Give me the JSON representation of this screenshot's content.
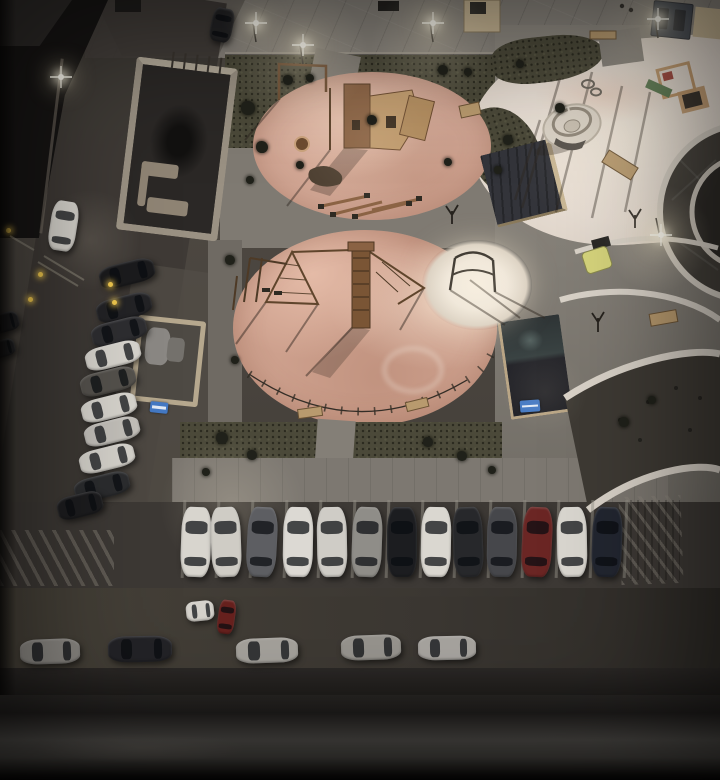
{
  "scene": {
    "size": {
      "w": 720,
      "h": 780
    },
    "palette": {
      "base": "#4a453f",
      "walk": "#8b867e",
      "grass": "#4b4939",
      "salmon": "#d2a795",
      "plaza": "#e7ddd3",
      "pad": "#efe7db",
      "road": "#3e3a35",
      "sidewalk": "#7d7871",
      "parking": "#3d3935",
      "wall": "#9a9183",
      "kiosk": "#33343a",
      "trim": "#c9b795",
      "sign": "#4479c4",
      "yellow": "#d6d47c",
      "bench": "#b89a6e",
      "slide": "#5f7d54",
      "wood": "#8a6243",
      "bollard": "#f0c84e",
      "glow": "#fff3d8"
    },
    "cars": {
      "leftRow": [
        {
          "x": 127,
          "y": 273,
          "c": "#1b1b1d"
        },
        {
          "x": 124,
          "y": 307,
          "c": "#232326"
        },
        {
          "x": 119,
          "y": 331,
          "c": "#2e2e31"
        },
        {
          "x": 113,
          "y": 355,
          "c": "#d8d5ce"
        },
        {
          "x": 108,
          "y": 381,
          "c": "#55524d"
        },
        {
          "x": 109,
          "y": 407,
          "c": "#d8d5ce"
        },
        {
          "x": 112,
          "y": 431,
          "c": "#c4c1bb"
        },
        {
          "x": 107,
          "y": 458,
          "c": "#d6d3cc"
        },
        {
          "x": 102,
          "y": 486,
          "c": "#2c2d2f"
        },
        {
          "x": 80,
          "y": 505,
          "w": 46,
          "c": "#1d1d1f"
        }
      ],
      "edge": [
        {
          "x": 4,
          "y": 322,
          "w": 30,
          "h": 19,
          "r": -15,
          "c": "#1f1f21"
        },
        {
          "x": 2,
          "y": 348,
          "w": 26,
          "h": 17,
          "r": -15,
          "c": "#242426"
        }
      ],
      "bottomRow": [
        {
          "x": 196,
          "y": 542,
          "r": 2,
          "c": "#d8d5ce"
        },
        {
          "x": 226,
          "y": 542,
          "r": -2,
          "c": "#cfccc5"
        },
        {
          "x": 262,
          "y": 542,
          "r": 3,
          "c": "#5d5e62"
        },
        {
          "x": 298,
          "y": 542,
          "r": 1,
          "c": "#dcd9d3"
        },
        {
          "x": 332,
          "y": 542,
          "r": -1,
          "c": "#cfccc6"
        },
        {
          "x": 367,
          "y": 542,
          "r": 2,
          "c": "#8f8d88"
        },
        {
          "x": 402,
          "y": 542,
          "r": 0,
          "c": "#1c1d20"
        },
        {
          "x": 436,
          "y": 542,
          "r": 1,
          "c": "#dad7d0"
        },
        {
          "x": 468,
          "y": 542,
          "r": -2,
          "c": "#27282b"
        },
        {
          "x": 502,
          "y": 542,
          "r": 1,
          "c": "#46474b"
        },
        {
          "x": 537,
          "y": 542,
          "r": 3,
          "c": "#6b2624"
        },
        {
          "x": 572,
          "y": 542,
          "r": -1,
          "c": "#d9d6cf"
        },
        {
          "x": 607,
          "y": 542,
          "r": 2,
          "c": "#222630"
        }
      ],
      "street": [
        {
          "x": 50,
          "y": 651,
          "r": -2,
          "c": "#8c8984"
        },
        {
          "x": 140,
          "y": 649,
          "w": 64,
          "h": 26,
          "r": -1,
          "c": "#232327"
        },
        {
          "x": 267,
          "y": 650,
          "w": 62,
          "r": -2,
          "c": "#a5a29c"
        },
        {
          "x": 371,
          "y": 647,
          "r": -2,
          "c": "#97948e"
        },
        {
          "x": 447,
          "y": 648,
          "w": 58,
          "h": 24,
          "r": -1,
          "c": "#a8a5a0"
        }
      ],
      "misc": [
        {
          "x": 63,
          "y": 226,
          "w": 27,
          "h": 50,
          "r": 9,
          "c": "#d9d6cf"
        },
        {
          "x": 222,
          "y": 25,
          "w": 22,
          "h": 34,
          "r": 12,
          "c": "#232325"
        },
        {
          "x": 200,
          "y": 611,
          "w": 28,
          "h": 20,
          "r": -6,
          "c": "#d5d2cb"
        },
        {
          "x": 226,
          "y": 617,
          "w": 17,
          "h": 34,
          "r": 8,
          "c": "#67211e"
        }
      ]
    },
    "lightPools": [
      {
        "x": 300,
        "y": 55,
        "r": 95,
        "o": 0.22
      },
      {
        "x": 432,
        "y": 45,
        "r": 85,
        "o": 0.2
      },
      {
        "x": 657,
        "y": 35,
        "r": 85,
        "o": 0.2
      },
      {
        "x": 658,
        "y": 238,
        "r": 75,
        "o": 0.25
      },
      {
        "x": 232,
        "y": 505,
        "r": 100,
        "o": 0.16
      },
      {
        "x": 90,
        "y": 240,
        "r": 70,
        "o": 0.12
      },
      {
        "x": 620,
        "y": 140,
        "r": 150,
        "o": 0.1
      },
      {
        "x": 372,
        "y": 140,
        "r": 110,
        "o": 0.1
      },
      {
        "x": 477,
        "y": 284,
        "r": 70,
        "o": 0.26
      },
      {
        "x": 545,
        "y": 392,
        "r": 60,
        "o": 0.08
      }
    ],
    "lampFlares": [
      {
        "x": 253,
        "y": 20
      },
      {
        "x": 300,
        "y": 42
      },
      {
        "x": 430,
        "y": 20
      },
      {
        "x": 655,
        "y": 16
      },
      {
        "x": 658,
        "y": 232
      },
      {
        "x": 58,
        "y": 74
      }
    ],
    "bollards": [
      {
        "x": 6,
        "y": 228
      },
      {
        "x": 38,
        "y": 272
      },
      {
        "x": 28,
        "y": 297
      },
      {
        "x": 108,
        "y": 282
      },
      {
        "x": 112,
        "y": 300
      }
    ],
    "bushes": [
      {
        "x": 248,
        "y": 108,
        "r": 7
      },
      {
        "x": 262,
        "y": 147,
        "r": 6
      },
      {
        "x": 288,
        "y": 80,
        "r": 5
      },
      {
        "x": 310,
        "y": 78,
        "r": 4
      },
      {
        "x": 372,
        "y": 120,
        "r": 5
      },
      {
        "x": 443,
        "y": 70,
        "r": 5
      },
      {
        "x": 468,
        "y": 72,
        "r": 4
      },
      {
        "x": 560,
        "y": 108,
        "r": 5
      },
      {
        "x": 520,
        "y": 64,
        "r": 4
      },
      {
        "x": 250,
        "y": 180,
        "r": 4
      },
      {
        "x": 230,
        "y": 260,
        "r": 5
      },
      {
        "x": 235,
        "y": 360,
        "r": 4
      },
      {
        "x": 222,
        "y": 438,
        "r": 6
      },
      {
        "x": 252,
        "y": 455,
        "r": 5
      },
      {
        "x": 428,
        "y": 442,
        "r": 5
      },
      {
        "x": 462,
        "y": 456,
        "r": 5
      },
      {
        "x": 492,
        "y": 470,
        "r": 4
      },
      {
        "x": 206,
        "y": 472,
        "r": 4
      },
      {
        "x": 624,
        "y": 422,
        "r": 5
      },
      {
        "x": 652,
        "y": 400,
        "r": 4
      },
      {
        "x": 300,
        "y": 165,
        "r": 4
      },
      {
        "x": 448,
        "y": 162,
        "r": 4
      },
      {
        "x": 508,
        "y": 140,
        "r": 5
      },
      {
        "x": 498,
        "y": 170,
        "r": 4
      }
    ],
    "stallLines": {
      "y": 500,
      "h": 78,
      "xs": [
        182,
        216,
        250,
        284,
        318,
        352,
        386,
        420,
        454,
        488,
        522,
        556,
        590,
        624
      ]
    }
  }
}
